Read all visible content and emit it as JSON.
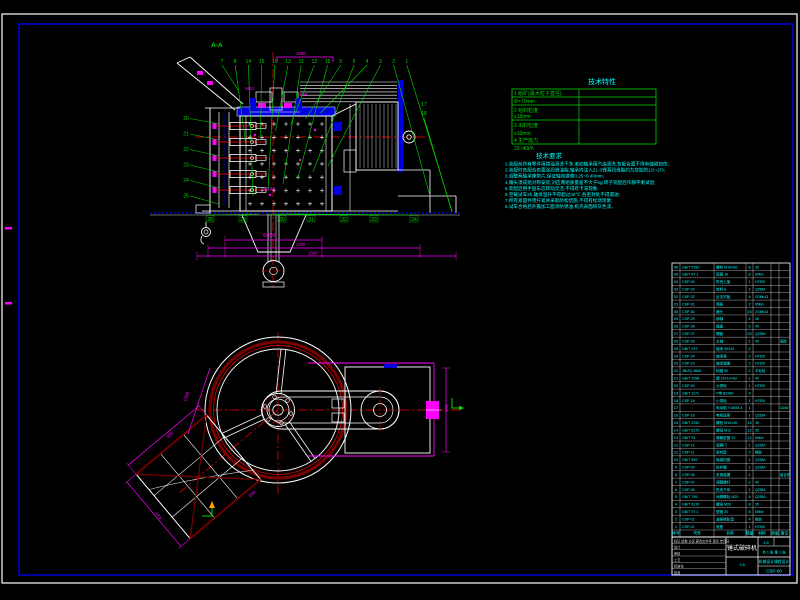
{
  "drawing": {
    "bg_color": "#000000",
    "frame_outer_color": "#ffffff",
    "frame_inner_color": "#0000bf",
    "line_colors": {
      "outline": "#ffffff",
      "fill": "#0000e0",
      "dimension": "#ff00ff",
      "centerline": "#ff0000",
      "leader": "#00d900",
      "notes": "#00ffff",
      "dark_red": "#7a0000"
    }
  },
  "section_view": {
    "label": "A-A",
    "balloons_top": [
      "7",
      "8",
      "14",
      "16",
      "10",
      "13",
      "11",
      "12",
      "15",
      "5",
      "6",
      "4",
      "3",
      "2",
      "1"
    ],
    "balloons_left": [
      "20",
      "21",
      "22",
      "23",
      "24",
      "25"
    ],
    "balloons_right": [
      "17",
      "18"
    ],
    "balloons_bottom": [
      "28",
      "29",
      "30",
      "31",
      "32",
      "33",
      "34"
    ],
    "dims": {
      "top": "1080",
      "hub": "M10",
      "shaft": "Φ65",
      "funnel": "Φ240",
      "base1": "Φ420",
      "base2": "1330",
      "base3": "1660"
    }
  },
  "plan_view": {
    "dims": {
      "left": "1368",
      "right": "900",
      "hopper_side": "500",
      "hopper_far": "424",
      "hopper_near": "400"
    }
  },
  "tech_table": {
    "title": "技术特性",
    "rows": [
      {
        "label": "1 给矿(最大粒子直径)",
        "value": "Φ×70mm"
      },
      {
        "label": "2 给料粒度",
        "value": "≤15mm"
      },
      {
        "label": "3 出料粒度",
        "value": "≤10mm"
      },
      {
        "label": "4 生产能力",
        "value": "20~40t/h"
      }
    ]
  },
  "tech_notes": {
    "title": "技术要求",
    "lines": [
      "1.装配前所有零件用煤油清洗干净,滚动轴承用汽油清洗,各配合面不得有磕碰划伤;",
      "2.装配时各配合表面涂润滑油脂,轴承内注入ZL-3锂基润滑脂约为空腔的1/2~2/3;",
      "3.调整两轴承座垫片,保证轴向游隙0.25~0.40mm;",
      "4.锤头须成组对称安装,对应两组质量差不大于5g,转子装配后作静平衡试验;",
      "5.装配后用手盘车应转动灵活,不得有卡滞现象;",
      "6.空载试车2h,轴承温升不得超过30℃,各密封处不得漏油;",
      "7.所有紧固件须拧紧并采取防松措施,不得有松动现象;",
      "8.试车合格后外露加工面涂防锈油,机壳表面喷灰色漆。"
    ]
  },
  "parts_list": {
    "headers": [
      "序号",
      "代号",
      "名称",
      "数量",
      "材料",
      "质量",
      "备注"
    ],
    "rows": [
      {
        "no": "36",
        "code": "GB/T 5782",
        "name": "螺栓 M16×60",
        "qty": "8",
        "mat": "35",
        "note": ""
      },
      {
        "no": "35",
        "code": "GB/T 97.1",
        "name": "垫圈 16",
        "qty": "8",
        "mat": "65Mn",
        "note": ""
      },
      {
        "no": "34",
        "code": "CSP-34",
        "name": "机壳上盖",
        "qty": "1",
        "mat": "HT200",
        "note": ""
      },
      {
        "no": "33",
        "code": "CSP-33",
        "name": "给料斗",
        "qty": "1",
        "mat": "Q235A",
        "note": ""
      },
      {
        "no": "32",
        "code": "CSP-32",
        "name": "反击衬板",
        "qty": "4",
        "mat": "ZGMn13",
        "note": ""
      },
      {
        "no": "31",
        "code": "CSP-31",
        "name": "筛板",
        "qty": "2",
        "mat": "65Mn",
        "note": ""
      },
      {
        "no": "30",
        "code": "CSP-30",
        "name": "锤头",
        "qty": "24",
        "mat": "ZGMn13",
        "note": ""
      },
      {
        "no": "29",
        "code": "CSP-29",
        "name": "销轴",
        "qty": "4",
        "mat": "45",
        "note": ""
      },
      {
        "no": "28",
        "code": "CSP-28",
        "name": "锤盘",
        "qty": "5",
        "mat": "45",
        "note": ""
      },
      {
        "no": "27",
        "code": "CSP-27",
        "name": "隔套",
        "qty": "20",
        "mat": "Q235A",
        "note": ""
      },
      {
        "no": "26",
        "code": "CSP-26",
        "name": "主轴",
        "qty": "1",
        "mat": "45",
        "note": "调质"
      },
      {
        "no": "25",
        "code": "GB/T 297",
        "name": "轴承 30310",
        "qty": "2",
        "mat": "",
        "note": ""
      },
      {
        "no": "24",
        "code": "CSP-24",
        "name": "轴承座",
        "qty": "2",
        "mat": "HT200",
        "note": ""
      },
      {
        "no": "23",
        "code": "CSP-23",
        "name": "轴承端盖",
        "qty": "2",
        "mat": "HT150",
        "note": ""
      },
      {
        "no": "22",
        "code": "JB/ZQ 4606",
        "name": "毡圈 50",
        "qty": "2",
        "mat": "羊毛毡",
        "note": ""
      },
      {
        "no": "21",
        "code": "GB/T 1096",
        "name": "键 16×10×63",
        "qty": "1",
        "mat": "45",
        "note": ""
      },
      {
        "no": "20",
        "code": "CSP-20",
        "name": "大带轮",
        "qty": "1",
        "mat": "HT200",
        "note": ""
      },
      {
        "no": "19",
        "code": "GB/T 1171",
        "name": "V带 B2240",
        "qty": "3",
        "mat": "",
        "note": ""
      },
      {
        "no": "18",
        "code": "CSP-18",
        "name": "小带轮",
        "qty": "1",
        "mat": "HT200",
        "note": ""
      },
      {
        "no": "17",
        "code": "",
        "name": "电动机 Y160M-4",
        "qty": "1",
        "mat": "",
        "note": "11kW"
      },
      {
        "no": "16",
        "code": "CSP-16",
        "name": "电机底座",
        "qty": "1",
        "mat": "Q235A",
        "note": ""
      },
      {
        "no": "15",
        "code": "GB/T 5782",
        "name": "螺栓 M12×40",
        "qty": "12",
        "mat": "35",
        "note": ""
      },
      {
        "no": "14",
        "code": "GB/T 6170",
        "name": "螺母 M12",
        "qty": "12",
        "mat": "35",
        "note": ""
      },
      {
        "no": "13",
        "code": "GB/T 93",
        "name": "弹簧垫圈 12",
        "qty": "12",
        "mat": "65Mn",
        "note": ""
      },
      {
        "no": "12",
        "code": "CSP-12",
        "name": "观察门",
        "qty": "1",
        "mat": "Q235A",
        "note": ""
      },
      {
        "no": "11",
        "code": "CSP-11",
        "name": "密封垫",
        "qty": "2",
        "mat": "橡胶",
        "note": ""
      },
      {
        "no": "10",
        "code": "GB/T 892",
        "name": "轴端挡圈",
        "qty": "1",
        "mat": "Q235A",
        "note": ""
      },
      {
        "no": "9",
        "code": "CSP-09",
        "name": "防护罩",
        "qty": "1",
        "mat": "Q235A",
        "note": ""
      },
      {
        "no": "8",
        "code": "CSP-08",
        "name": "张紧装置",
        "qty": "1",
        "mat": "",
        "note": "组合件"
      },
      {
        "no": "7",
        "code": "CSP-07",
        "name": "调整螺杆",
        "qty": "2",
        "mat": "45",
        "note": ""
      },
      {
        "no": "6",
        "code": "CSP-06",
        "name": "机壳下体",
        "qty": "1",
        "mat": "Q235A",
        "note": ""
      },
      {
        "no": "5",
        "code": "GB/T 799",
        "name": "地脚螺栓 M20",
        "qty": "4",
        "mat": "Q235A",
        "note": ""
      },
      {
        "no": "4",
        "code": "GB/T 6170",
        "name": "螺母 M20",
        "qty": "8",
        "mat": "35",
        "note": ""
      },
      {
        "no": "3",
        "code": "GB/T 97.1",
        "name": "垫圈 20",
        "qty": "8",
        "mat": "65Mn",
        "note": ""
      },
      {
        "no": "2",
        "code": "CSP-02",
        "name": "减振橡胶垫",
        "qty": "4",
        "mat": "橡胶",
        "note": ""
      },
      {
        "no": "1",
        "code": "CSP-01",
        "name": "底座",
        "qty": "1",
        "mat": "HT200",
        "note": ""
      }
    ]
  },
  "title_block": {
    "title": "锤式破碎机",
    "unit": "机械设计课程设计",
    "drawing_no": "CSP-00",
    "scale": "1:5",
    "sheet": "共 1 张 第 1 张",
    "left_rows": [
      "标记 处数 分区 更改文件号 签名 年月日",
      "设计",
      "审核",
      "工艺",
      "标准化",
      "批准"
    ]
  }
}
